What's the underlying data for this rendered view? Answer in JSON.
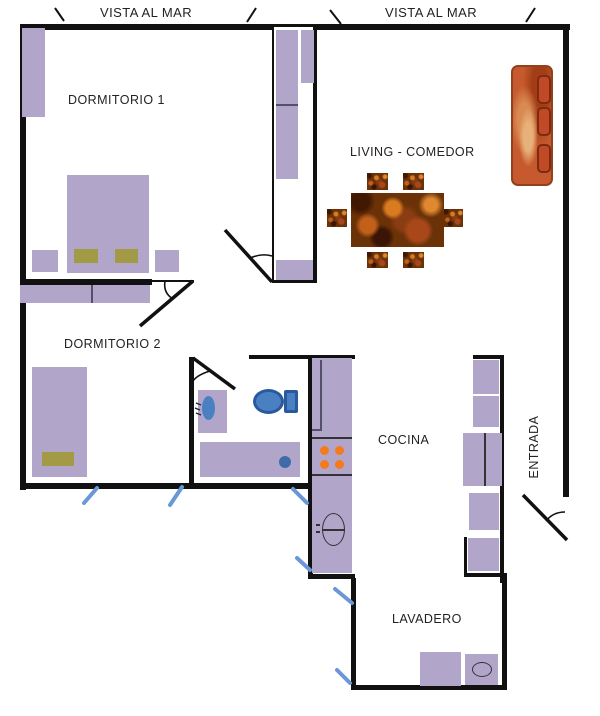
{
  "plan": {
    "exterior": {
      "vista_left": "VISTA AL MAR",
      "vista_right": "VISTA AL MAR"
    },
    "rooms": {
      "dormitorio1": "DORMITORIO 1",
      "living": "LIVING - COMEDOR",
      "dormitorio2": "DORMITORIO 2",
      "cocina": "COCINA",
      "entrada": "ENTRADA",
      "lavadero": "LAVADERO"
    },
    "colors": {
      "wall": "#111111",
      "furniture": "#b1a6c9",
      "pillow": "#a29a45",
      "fixture_blue": "#4a7fc1",
      "fixture_blue_dark": "#2a5a9e",
      "burner_orange": "#f47a1e",
      "sofa_orange": "#c65a2e",
      "table_brown": "#6b3208",
      "window_mark_blue": "#6b97d6"
    }
  }
}
